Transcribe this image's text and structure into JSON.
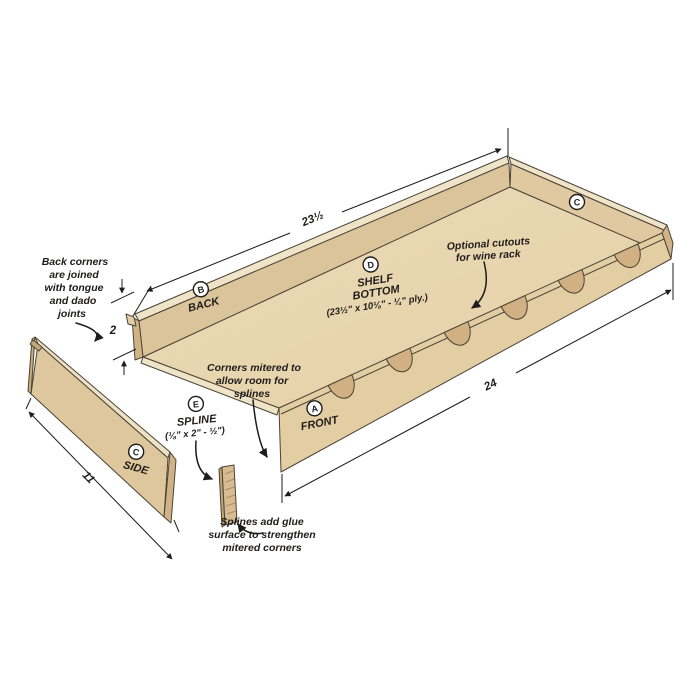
{
  "diagram_title": "Shelf tray construction diagram",
  "colors": {
    "background": "#ffffff",
    "wood_face_back": "#dcc49a",
    "wood_face_side": "#e0c9a0",
    "wood_face_front": "#e3cda3",
    "wood_face_side_loose": "#dfc79d",
    "wood_top_strip": "#f0e4c8",
    "wood_shelf_light": "#ecdcba",
    "wood_shelf_dark": "#e4cfa4",
    "wood_end_grain": "#d0b286",
    "wood_cutout": "#d1b183",
    "wood_spline": "#d8bc91",
    "outline": "#4a4336",
    "ink": "#1f1d1b"
  },
  "labels": {
    "back": {
      "letter": "B",
      "name": "BACK"
    },
    "front": {
      "letter": "A",
      "name": "FRONT"
    },
    "side_right": {
      "letter": "C"
    },
    "side": {
      "letter": "C",
      "name": "SIDE"
    },
    "shelf": {
      "letter": "D",
      "line1": "SHELF",
      "line2": "BOTTOM",
      "dims": "(23½\" x 10⅛\" - ¼\" ply.)"
    },
    "spline": {
      "letter": "E",
      "name": "SPLINE",
      "dims": "(⅛\" x 2\" - ½\")"
    }
  },
  "dimensions": {
    "back_length": "23½",
    "front_length": "24",
    "side_length": "11",
    "back_height": "2"
  },
  "annotations": {
    "back_corners": {
      "lines": [
        "Back corners",
        "are joined",
        "with tongue",
        "and dado",
        "joints"
      ]
    },
    "corners_mitered": {
      "lines": [
        "Corners mitered to",
        "allow room for",
        "splines"
      ]
    },
    "optional_cutouts": {
      "lines": [
        "Optional cutouts",
        "for wine rack"
      ]
    },
    "splines_glue": {
      "lines": [
        "Splines add glue",
        "surface to strengthen",
        "mitered corners"
      ]
    }
  }
}
